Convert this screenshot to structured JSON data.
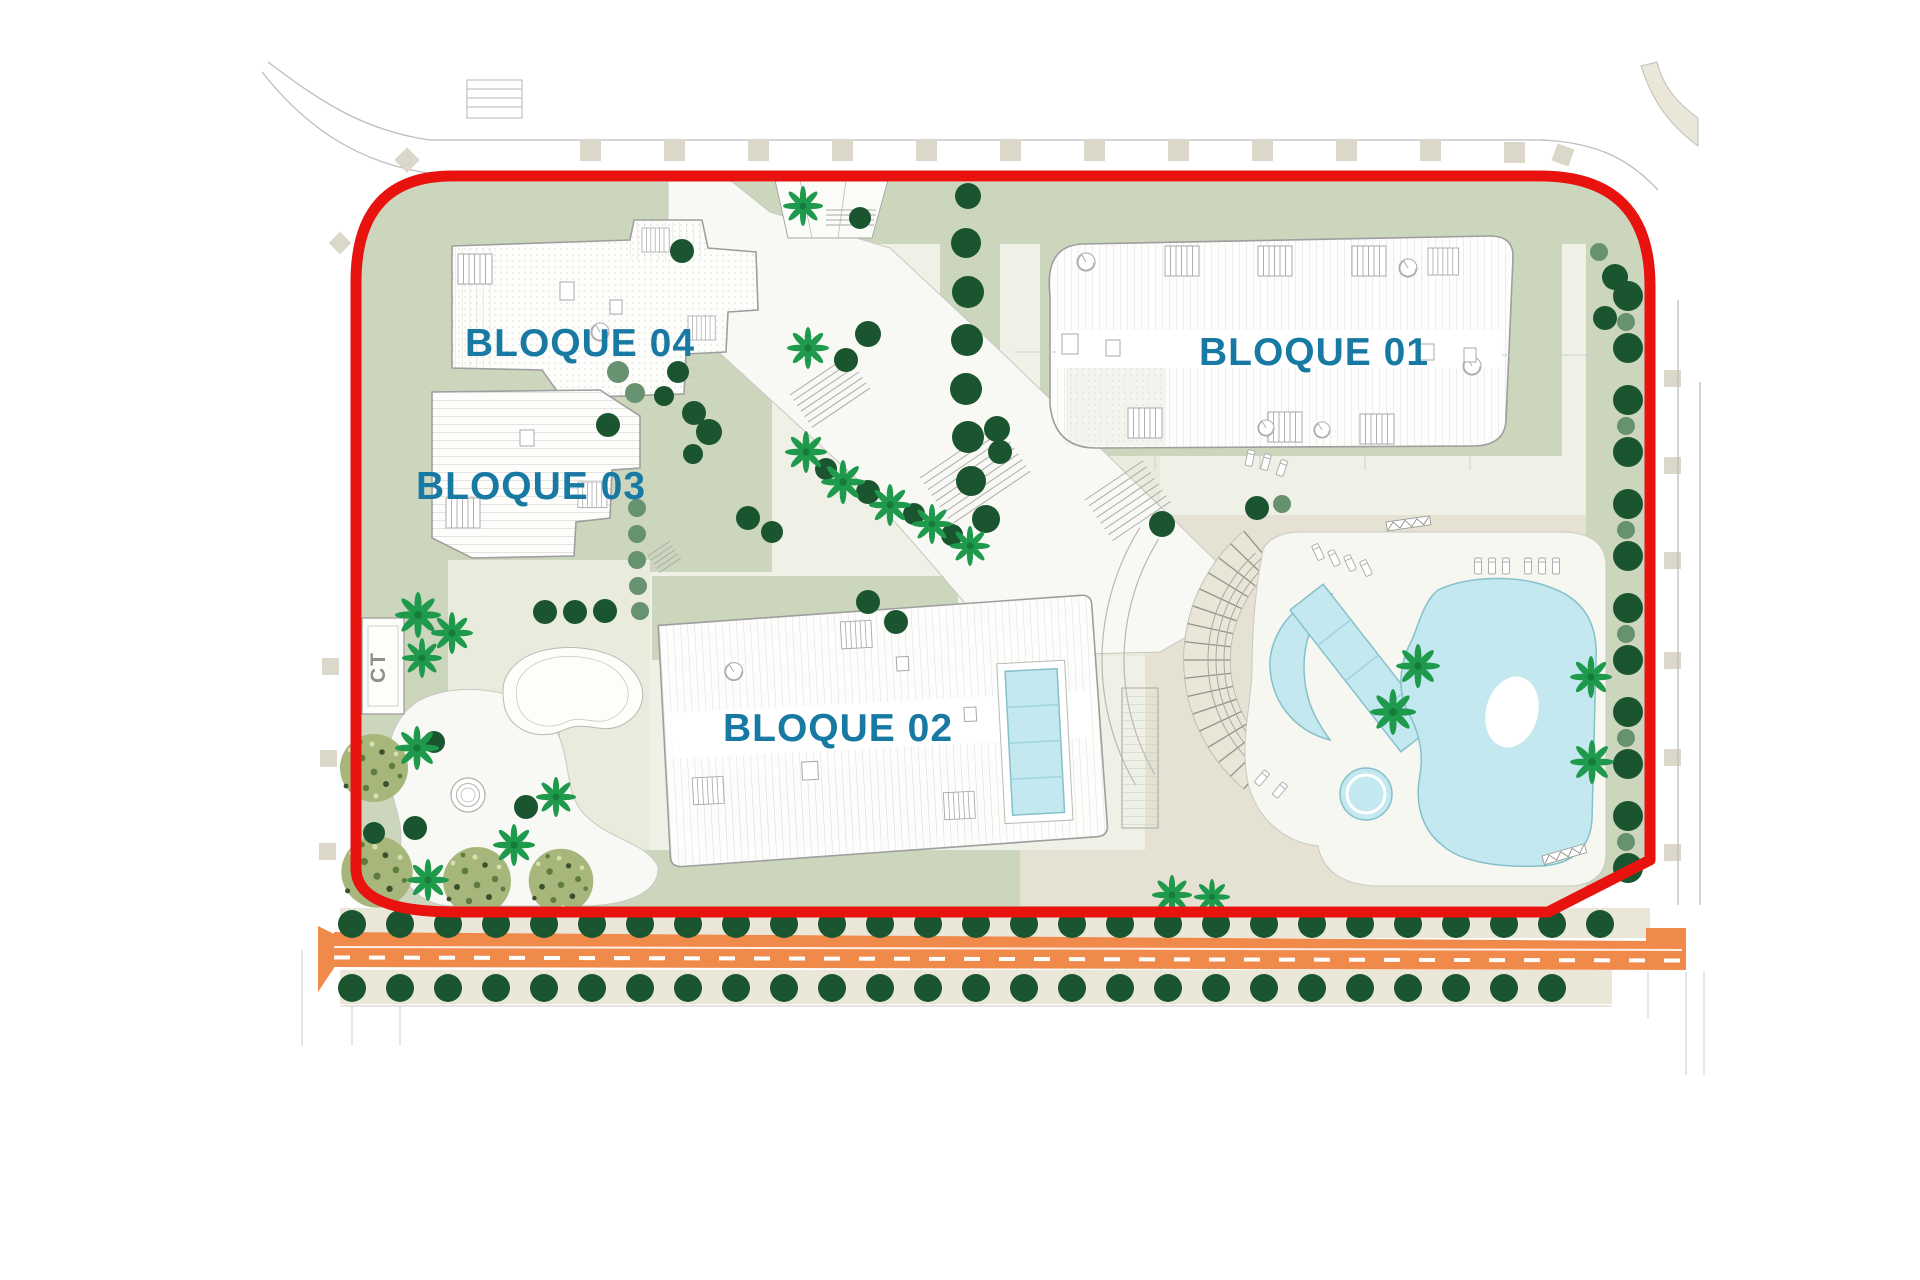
{
  "plan": {
    "title": "Residential site plan",
    "blocks": [
      {
        "id": "bloque-01",
        "label": "BLOQUE 01"
      },
      {
        "id": "bloque-02",
        "label": "BLOQUE 02"
      },
      {
        "id": "bloque-03",
        "label": "BLOQUE 03"
      },
      {
        "id": "bloque-04",
        "label": "BLOQUE 04"
      }
    ],
    "utility_label": "CT"
  },
  "colors": {
    "boundary_red": "#e8130f",
    "road_orange": "#f08a4b",
    "pool_blue": "#c3e8ef",
    "pool_stroke": "#86c0ca",
    "sage": "#ccd6bd",
    "pale": "#eff1e6",
    "pale2": "#e9ecdc",
    "deck": "#e5e2d3",
    "strip": "#eae7d9",
    "beige_sq": "#dbd8c9",
    "tree_dark": "#1a5530",
    "tree_med": "#67926f",
    "palm": "#1f9a4d",
    "canopy": "#a7b77b",
    "canopy_dot": "#5f7c40",
    "label_blue": "#1879a3",
    "line_gray": "#bdbdbd",
    "build_stroke": "#9e9e9e",
    "ct_gray": "#8f8f8f"
  },
  "vegetation": {
    "rows": [
      {
        "group": "g-street-top",
        "class": "tree-dark",
        "x": 352,
        "y": 924,
        "step": 48,
        "count": 27,
        "r": 14
      },
      {
        "group": "g-street-bottom",
        "class": "tree-dark",
        "x": 352,
        "y": 988,
        "step": 48,
        "count": 26,
        "r": 14
      },
      {
        "group": "g-boundary-col",
        "class": "tree-dark",
        "x": 1628,
        "y": 296,
        "step": 52,
        "count": 12,
        "r": 15,
        "vertical": true
      },
      {
        "group": "g-boundary-col",
        "class": "tree-med",
        "x": 1626,
        "y": 322,
        "step": 104,
        "count": 6,
        "r": 9,
        "vertical": true
      }
    ],
    "dark_trees": [
      [
        682,
        251,
        12
      ],
      [
        860,
        218,
        11
      ],
      [
        868,
        334,
        13
      ],
      [
        846,
        360,
        12
      ],
      [
        678,
        372,
        11
      ],
      [
        664,
        396,
        10
      ],
      [
        694,
        413,
        12
      ],
      [
        709,
        432,
        13
      ],
      [
        693,
        454,
        10
      ],
      [
        608,
        425,
        12
      ],
      [
        748,
        518,
        12
      ],
      [
        772,
        532,
        11
      ],
      [
        826,
        469,
        11
      ],
      [
        868,
        492,
        12
      ],
      [
        914,
        514,
        11
      ],
      [
        952,
        535,
        11
      ],
      [
        868,
        602,
        12
      ],
      [
        896,
        622,
        12
      ],
      [
        545,
        612,
        12
      ],
      [
        575,
        612,
        12
      ],
      [
        605,
        611,
        12
      ],
      [
        997,
        429,
        13
      ],
      [
        1000,
        452,
        12
      ],
      [
        1162,
        524,
        13
      ],
      [
        1257,
        508,
        12
      ],
      [
        1615,
        277,
        13
      ],
      [
        1605,
        318,
        12
      ],
      [
        374,
        833,
        11
      ],
      [
        415,
        828,
        12
      ],
      [
        526,
        807,
        12
      ],
      [
        434,
        742,
        11
      ]
    ],
    "medium_trees": [
      [
        618,
        372,
        11
      ],
      [
        635,
        393,
        10
      ],
      [
        637,
        508,
        9
      ],
      [
        637,
        534,
        9
      ],
      [
        637,
        560,
        9
      ],
      [
        638,
        586,
        9
      ],
      [
        640,
        611,
        9
      ],
      [
        1599,
        252,
        9
      ],
      [
        1282,
        504,
        9
      ]
    ],
    "path_column": [
      [
        968,
        196,
        13
      ],
      [
        966,
        243,
        15
      ],
      [
        968,
        292,
        16
      ],
      [
        967,
        340,
        16
      ],
      [
        966,
        389,
        16
      ],
      [
        968,
        437,
        16
      ],
      [
        971,
        481,
        15
      ],
      [
        986,
        519,
        14
      ]
    ],
    "palms": [
      [
        803,
        206,
        1
      ],
      [
        808,
        348,
        1.05
      ],
      [
        806,
        452,
        1.05
      ],
      [
        843,
        482,
        1.1
      ],
      [
        890,
        505,
        1.05
      ],
      [
        932,
        524,
        1
      ],
      [
        970,
        546,
        1
      ],
      [
        418,
        615,
        1.15
      ],
      [
        452,
        633,
        1.05
      ],
      [
        422,
        658,
        1
      ],
      [
        417,
        748,
        1.1
      ],
      [
        428,
        880,
        1.05
      ],
      [
        514,
        845,
        1.05
      ],
      [
        556,
        797,
        1
      ],
      [
        1418,
        666,
        1.1
      ],
      [
        1393,
        712,
        1.15
      ],
      [
        1591,
        677,
        1.05
      ],
      [
        1592,
        762,
        1.1
      ],
      [
        1172,
        895,
        1
      ],
      [
        1212,
        897,
        0.9
      ]
    ],
    "canopies": [
      [
        374,
        768,
        1
      ],
      [
        377,
        872,
        1.05
      ],
      [
        477,
        881,
        1
      ],
      [
        561,
        881,
        0.95
      ]
    ]
  }
}
